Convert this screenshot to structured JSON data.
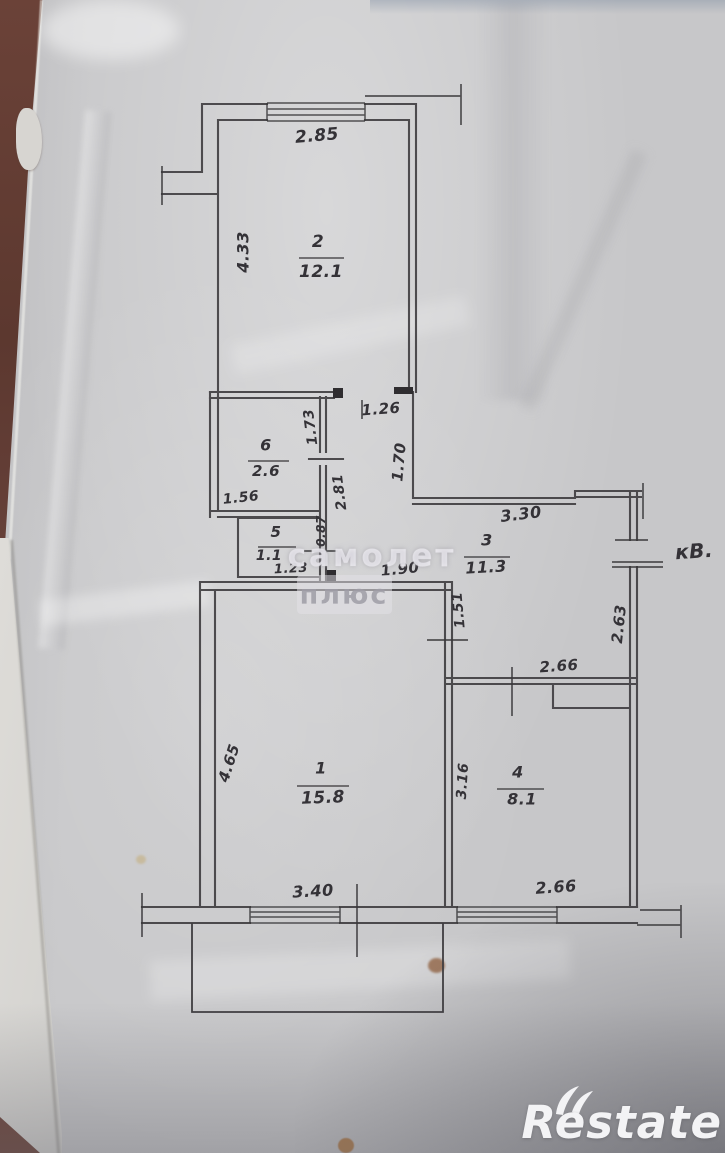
{
  "colors": {
    "paper": "#c7c7c9",
    "ink": "#343237",
    "wood": "#6b4238",
    "logo": "#f3f3f5",
    "watermark": "#b9b6c0"
  },
  "photo": {
    "watermark": {
      "line1": "самолет",
      "line2": "плюс"
    },
    "brand": {
      "name": "Restate"
    }
  },
  "plan": {
    "rooms": {
      "room1": {
        "number": "1",
        "area": "15.8"
      },
      "room2": {
        "number": "2",
        "area": "12.1"
      },
      "room3": {
        "number": "3",
        "area": "11.3"
      },
      "room4": {
        "number": "4",
        "area": "8.1"
      },
      "room5": {
        "number": "5",
        "area": "1.1"
      },
      "room6": {
        "number": "6",
        "area": "2.6"
      }
    },
    "dims": {
      "room2_width": "2.85",
      "room2_height": "4.33",
      "room2_door": "1.26",
      "room6_height": "1.73",
      "room6_width": "1.56",
      "corridor_height": "1.70",
      "corridor_length": "2.81",
      "room5_height": "0.87",
      "room5_width": "1.23",
      "hall_passage": "1.90",
      "hall_width": "3.30",
      "hall_height": "2.63",
      "hall_left": "1.51",
      "room4_top_width": "2.66",
      "room1_height": "4.65",
      "room1_width": "3.40",
      "room4_left_height": "3.16",
      "room4_width": "2.66",
      "entrance_label": "кВ."
    }
  }
}
